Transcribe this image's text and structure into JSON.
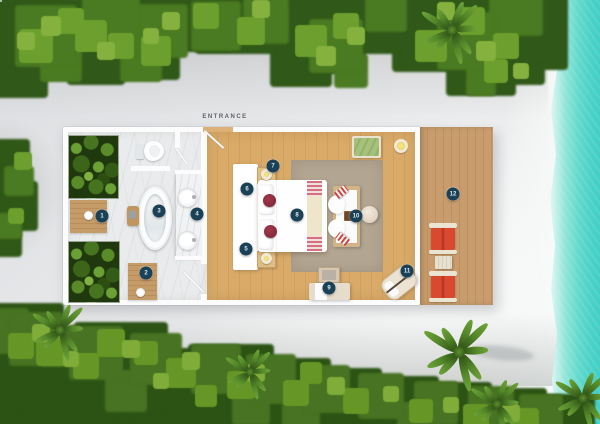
{
  "plan": {
    "entrance_label": "ENTRANCE",
    "marker_color": "#1b4156",
    "marker_text_color": "#d9e7f0",
    "markers": [
      {
        "n": "1",
        "x": 102,
        "y": 216
      },
      {
        "n": "2",
        "x": 146,
        "y": 273
      },
      {
        "n": "3",
        "x": 159,
        "y": 211
      },
      {
        "n": "4",
        "x": 197,
        "y": 214
      },
      {
        "n": "5",
        "x": 246,
        "y": 249
      },
      {
        "n": "6",
        "x": 247,
        "y": 189
      },
      {
        "n": "7",
        "x": 273,
        "y": 166
      },
      {
        "n": "8",
        "x": 297,
        "y": 215
      },
      {
        "n": "9",
        "x": 329,
        "y": 288
      },
      {
        "n": "10",
        "x": 356,
        "y": 216
      },
      {
        "n": "11",
        "x": 407,
        "y": 271
      },
      {
        "n": "12",
        "x": 453,
        "y": 194
      }
    ]
  },
  "palette": {
    "sand": "#e6e7e9",
    "water_turquoise": "#48d1c8",
    "foliage_green": "#3f6d1e",
    "bedroom_wood": "#d7a765",
    "deck_wood": "#c79b6b",
    "bathroom_marble": "#e9ebed",
    "wall_white": "#fcfcfd",
    "rug_taupe": "#b2a591",
    "deck_chair_red": "#ce3c2d",
    "bed_cushion_red": "#8d2e3b",
    "bench_green": "#a5c17b",
    "candle_yellow": "#e3cb5e",
    "marker_navy": "#1b4156"
  }
}
